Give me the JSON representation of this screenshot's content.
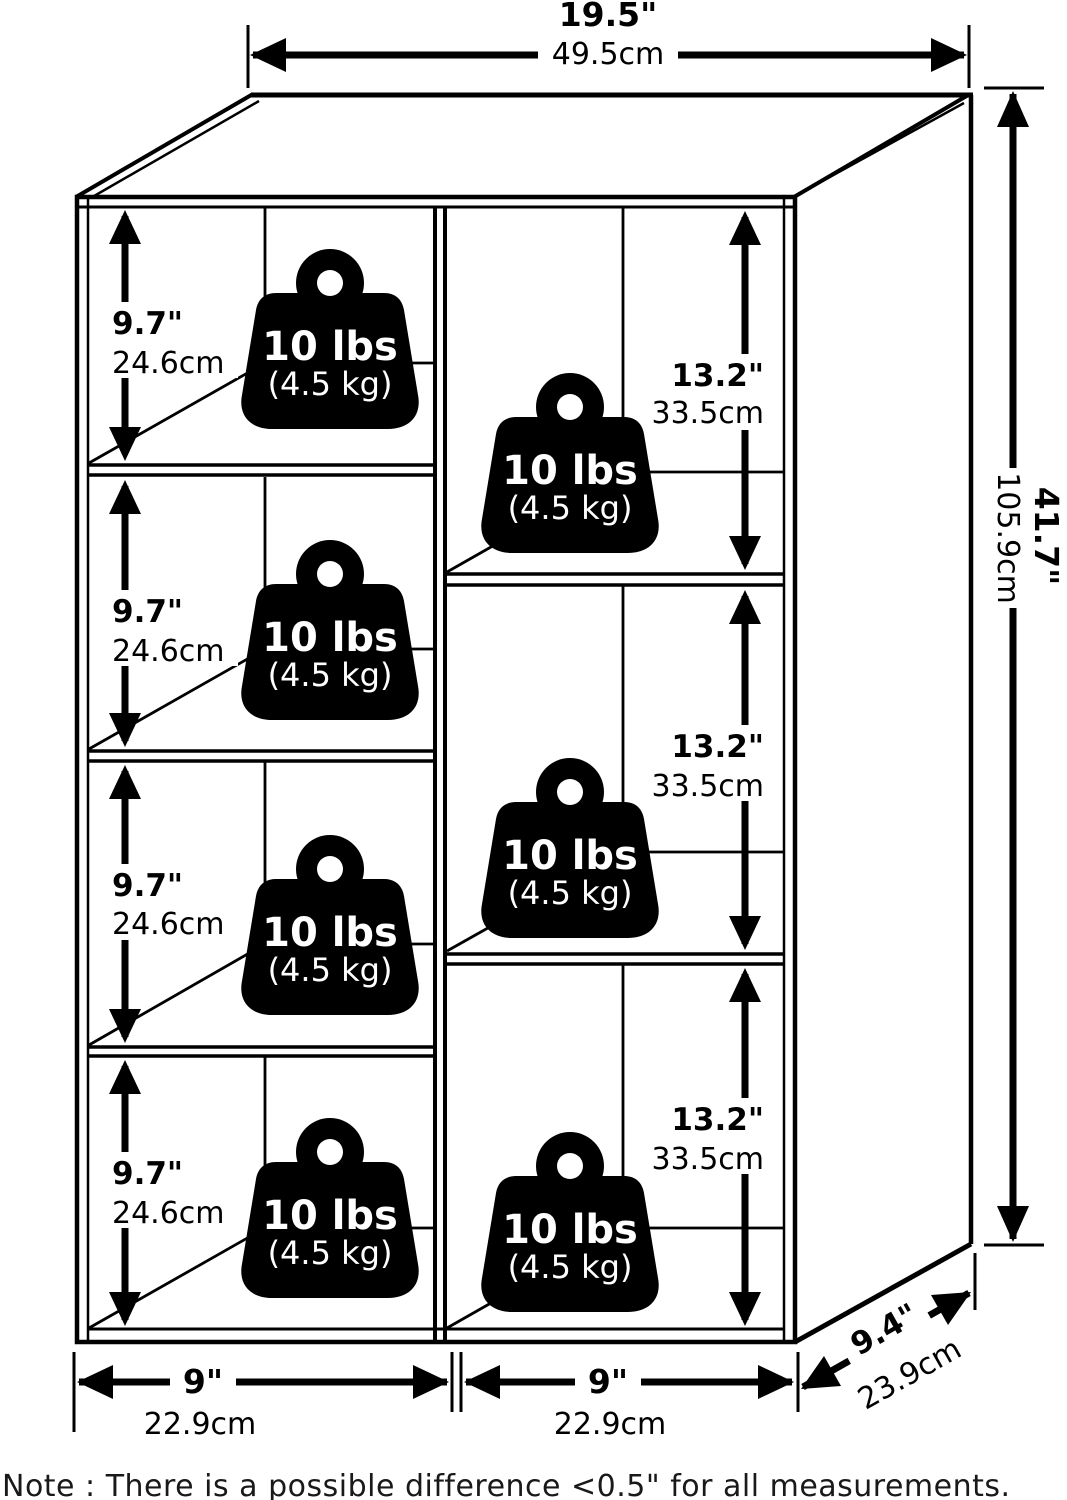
{
  "dims": {
    "width": {
      "in": "19.5\"",
      "cm": "49.5cm"
    },
    "height": {
      "in": "41.7\"",
      "cm": "105.9cm"
    },
    "depth": {
      "in": "9.4\"",
      "cm": "23.9cm"
    },
    "bottom": [
      {
        "in": "9\"",
        "cm": "22.9cm"
      },
      {
        "in": "9\"",
        "cm": "22.9cm"
      }
    ],
    "left_cubes": [
      {
        "in": "9.7\"",
        "cm": "24.6cm"
      },
      {
        "in": "9.7\"",
        "cm": "24.6cm"
      },
      {
        "in": "9.7\"",
        "cm": "24.6cm"
      },
      {
        "in": "9.7\"",
        "cm": "24.6cm"
      }
    ],
    "right_cubes": [
      {
        "in": "13.2\"",
        "cm": "33.5cm"
      },
      {
        "in": "13.2\"",
        "cm": "33.5cm"
      },
      {
        "in": "13.2\"",
        "cm": "33.5cm"
      }
    ]
  },
  "weights": [
    {
      "lbs": "10 lbs",
      "kg": "(4.5 kg)"
    },
    {
      "lbs": "10 lbs",
      "kg": "(4.5 kg)"
    },
    {
      "lbs": "10 lbs",
      "kg": "(4.5 kg)"
    },
    {
      "lbs": "10 lbs",
      "kg": "(4.5 kg)"
    },
    {
      "lbs": "10 lbs",
      "kg": "(4.5 kg)"
    },
    {
      "lbs": "10 lbs",
      "kg": "(4.5 kg)"
    },
    {
      "lbs": "10 lbs",
      "kg": "(4.5 kg)"
    }
  ],
  "note": "Note : There is a possible difference <0.5\" for all measurements.",
  "colors": {
    "line": "#000000",
    "background": "#ffffff",
    "note_text": "#191919"
  }
}
